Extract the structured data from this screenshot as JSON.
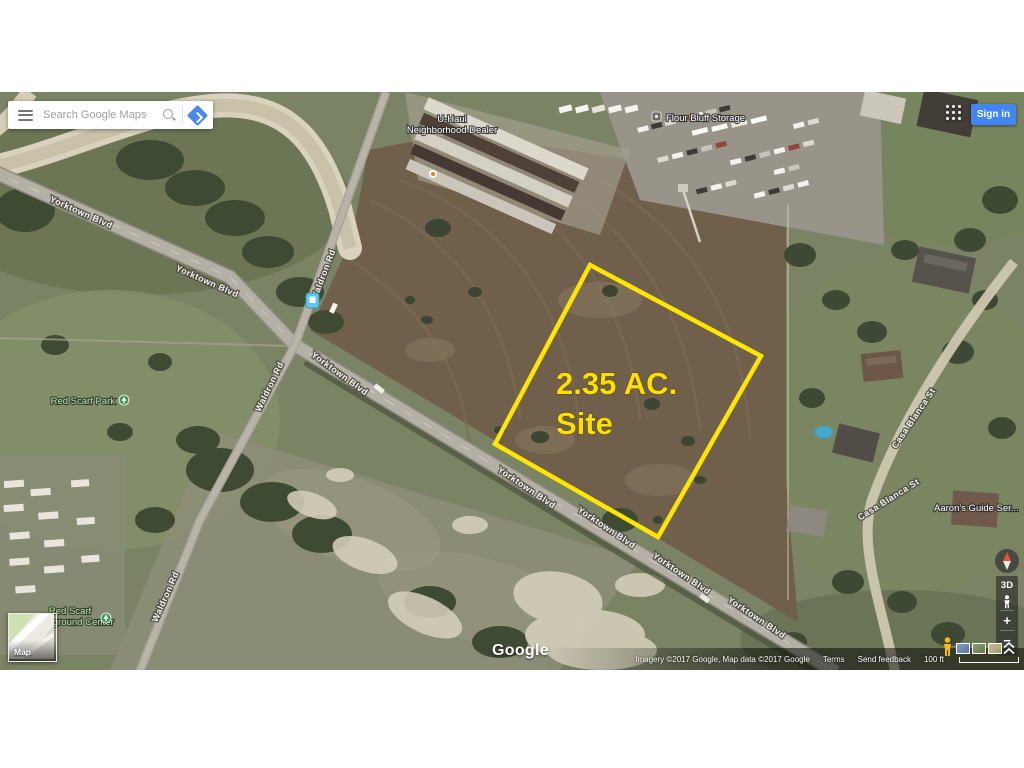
{
  "search_bar": {
    "placeholder": "Search Google Maps"
  },
  "header": {
    "sign_in_label": "Sign in",
    "signin_blue": "#4285f4"
  },
  "site": {
    "acreage": "2.35 AC.",
    "label": "Site",
    "outline_color": "#ffe600"
  },
  "pois": {
    "uhaul_line1": "U-Haul",
    "uhaul_line2": "Neighborhood Dealer",
    "storage": "Flour Bluff Storage",
    "park": "Red Scarf Park",
    "center_line1": "Red Scarf",
    "center_line2": "Playground Center",
    "guide_service": "Aaron's Guide Ser..."
  },
  "roads": {
    "yorktown": "Yorktown Blvd",
    "waldron": "Waldron Rd",
    "casa_blanca": "Casa Blanca St"
  },
  "controls": {
    "map_toggle": "Map",
    "three_d": "3D",
    "zoom_in": "+",
    "zoom_out": "−"
  },
  "footer": {
    "logo": "Google",
    "attribution": "Imagery ©2017 Google, Map data ©2017 Google",
    "terms": "Terms",
    "send_feedback": "Send feedback",
    "scale_label": "100 ft"
  }
}
